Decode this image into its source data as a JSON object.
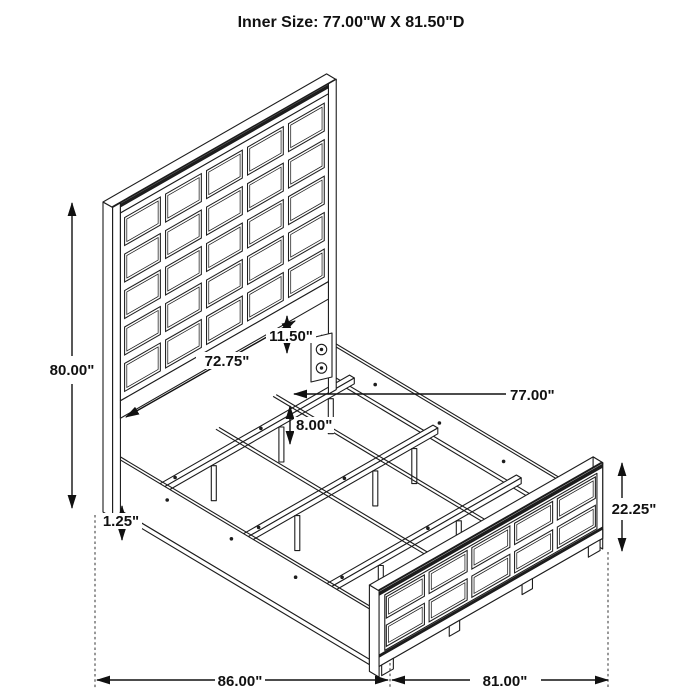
{
  "title": "Inner Size: 77.00\"W X 81.50\"D",
  "colors": {
    "line": "#1d1d1d",
    "dimension": "#111111",
    "background": "#ffffff"
  },
  "bed": {
    "headboard_grid": {
      "cols": 5,
      "rows": 5
    },
    "footboard_grid": {
      "cols": 5,
      "rows": 2
    }
  },
  "dimensions": {
    "overall_height": "80.00\"",
    "headboard_panel_width": "72.75\"",
    "headboard_to_rail_gap": "11.50\"",
    "inner_width": "77.00\"",
    "support_leg_height": "8.00\"",
    "rail_lip_thickness": "1.25\"",
    "footboard_height": "22.25\"",
    "overall_depth": "86.00\"",
    "footboard_width": "81.00\""
  }
}
